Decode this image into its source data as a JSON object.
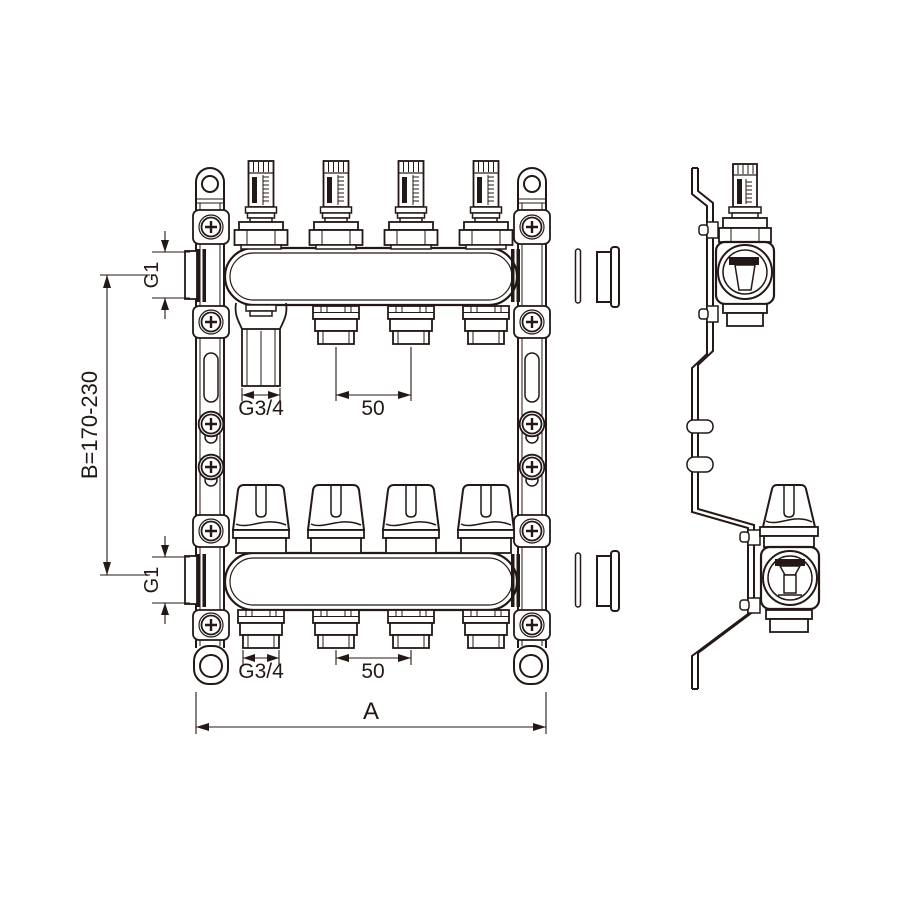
{
  "dims": {
    "port_thread_top": "G1",
    "port_thread_bottom": "G1",
    "bar_center_distance": "B=170-230",
    "outlet_thread_top": "G3/4",
    "outlet_pitch_top": "50",
    "outlet_thread_bottom": "G3/4",
    "outlet_pitch_bottom": "50",
    "overall_width": "A"
  },
  "components": {
    "flow_meters": 4,
    "valve_knobs": 4,
    "top_outlets": 4,
    "bottom_outlets": 4
  },
  "colors": {
    "line": "#231815",
    "background": "#ffffff"
  }
}
